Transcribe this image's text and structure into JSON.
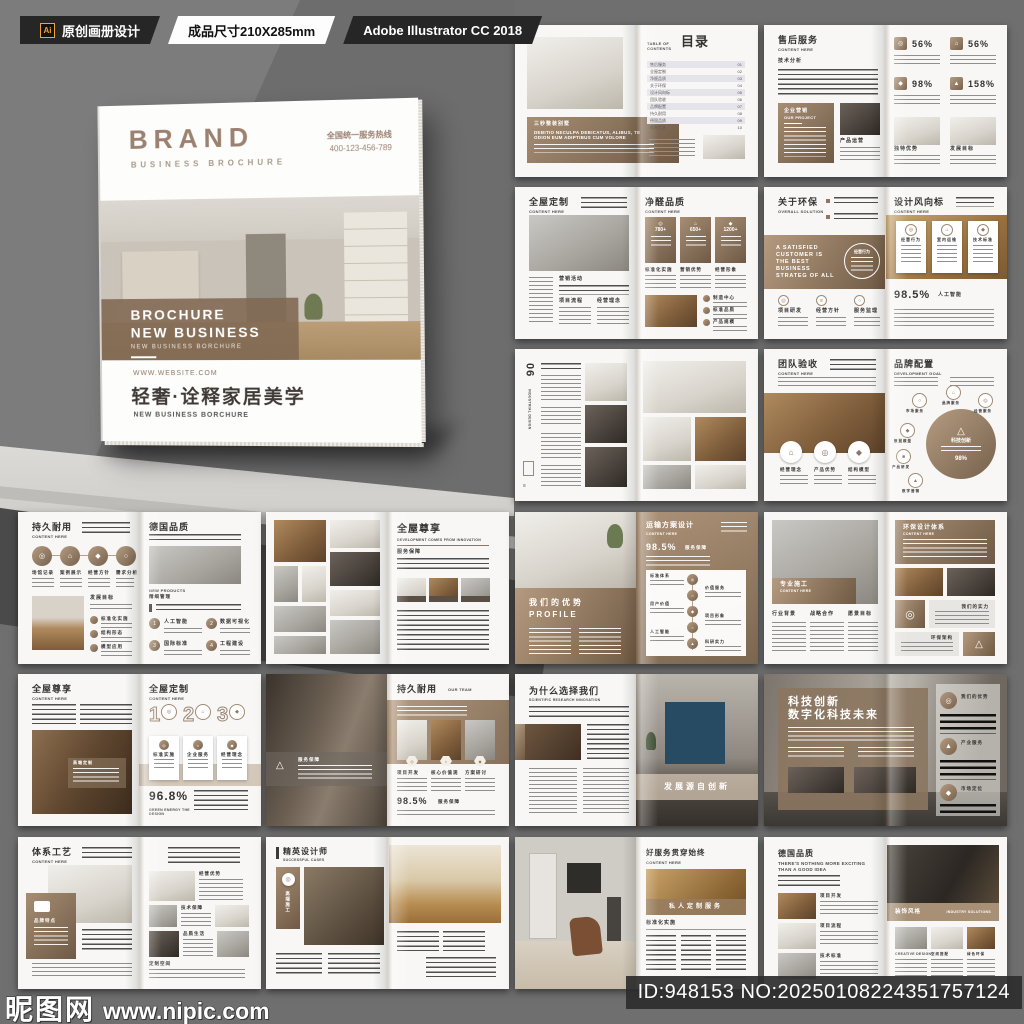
{
  "header": {
    "ai_badge": "Ai",
    "tag_design": "原创画册设计",
    "tag_size": "成品尺寸210X285mm",
    "tag_software": "Adobe Illustrator CC 2018"
  },
  "cover": {
    "brand": "BRAND",
    "brand_sub": "BUSINESS BROCHURE",
    "hotline_label": "全国统一服务热线",
    "hotline_number": "400-123-456-789",
    "band_line1": "BROCHURE",
    "band_line2": "NEW BUSINESS",
    "band_sub": "NEW BUSINESS BORCHURE",
    "website": "WWW.WEBSITE.COM",
    "tagline": "轻奢·诠释家居美学",
    "tagline_sub": "NEW BUSINESS BORCHURE"
  },
  "footer": {
    "site_name": "昵图网",
    "site_url": "www.nipic.com",
    "image_id": "ID:948153 NO:20250108224351757124"
  },
  "icons": {
    "target": "◎",
    "home": "⌂",
    "triangle": "△",
    "mail": "✉",
    "check": "✓",
    "diamond": "◆",
    "dot": "●",
    "square": "■",
    "circle": "○",
    "chart": "▲",
    "menu": "≡"
  },
  "spreads": {
    "s1": {
      "box_title": "三秒整装别墅",
      "box_text": "DEBITIO NECULPA DEBICATUS, ALIBUS, TE ODION EUM ADIPTIBUS CUM VOLORE",
      "toc_label": "TABLE OF CONTENTS",
      "toc_title": "目录",
      "toc": [
        "售后服务",
        "全屋定制",
        "净醛品质",
        "关于环保",
        "设计风向标",
        "团队验收",
        "品牌配置",
        "持久耐用",
        "德国品质",
        "体系工艺"
      ],
      "toc_nums": [
        "01",
        "02",
        "03",
        "04",
        "05",
        "06",
        "07",
        "08",
        "09",
        "10"
      ]
    },
    "s2": {
      "title": "售后服务",
      "title_en": "CONTENT HERE",
      "sub": "技术分析",
      "box_title": "企业营销",
      "box_en": "OUR PROJECT",
      "photo_cap": "产品运营",
      "stats": [
        "56%",
        "56%",
        "98%",
        "158%"
      ],
      "caps": [
        "独特优势",
        "发展目标"
      ]
    },
    "s3": {
      "title": "全屋定制",
      "title_en": "CONTENT HERE",
      "sec1": "营销活动",
      "sec2": "项目流程",
      "sec3": "经营理念",
      "right_title": "净醛品质",
      "right_en": "CONTENT HERE",
      "cards": [
        "780+",
        "650+",
        "1200+"
      ],
      "card_caps": [
        "标准化实施",
        "营销优势",
        "经营形象"
      ],
      "bullets": [
        "制造中心",
        "标准品质",
        "产品规模"
      ]
    },
    "s4": {
      "title": "关于环保",
      "title_en": "OVERALL SOLUTION",
      "quote": "A SATISFIED CUSTOMER IS THE BEST BUSINESS STRATEG OF ALL",
      "circle_cap": "经营行为",
      "cols": [
        "项目研发",
        "经营方针",
        "服务监理"
      ],
      "right_title": "设计风向标",
      "right_en": "CONTENT HERE",
      "cards": [
        "经营行为",
        "室内运维",
        "技术标准"
      ],
      "stat": "98.5%",
      "stat_cap": "人工智能"
    },
    "s5": {
      "num": "06",
      "side": "INDUSTRIAL DESIGN"
    },
    "s6": {
      "title": "团队验收",
      "title_en": "CONTENT HERE",
      "circles": [
        "经营理念",
        "产品优势",
        "结构模型"
      ],
      "right_title": "品牌配置",
      "right_en": "DEVELOPMENT GOAL",
      "center": "科技创新",
      "center_stat": "98%",
      "sats": [
        "市场服务",
        "品牌服务",
        "经营服务",
        "数据模型",
        "产品研发",
        "数字营销"
      ]
    },
    "s7": {
      "title": "持久耐用",
      "title_en": "CONTENT HERE",
      "circles": [
        "场馆记录",
        "案例展示",
        "经营方针",
        "需求分析"
      ],
      "sec": "发展目标",
      "list": [
        "标准化实施",
        "结构形态",
        "模型应用"
      ],
      "right_title": "德国品质",
      "right_en": "NEW PRODUCTS",
      "right_sub": "精细管理",
      "nums": [
        "1",
        "2",
        "3",
        "4"
      ],
      "num_caps": [
        "人工智能",
        "数据可视化",
        "国际标准",
        "工程建设"
      ]
    },
    "s8": {
      "right_title": "全屋尊享",
      "right_en": "DEVELOPMENT COMES FROM INNOVATION",
      "sub": "服务保障"
    },
    "s9": {
      "left_title": "我们的优势",
      "left_en": "PROFILE",
      "right_title": "运输方案设计",
      "right_en": "CONTENT HERE",
      "stat": "98.5%",
      "stat_cap": "服务保障",
      "tl_left": [
        "标准体系",
        "用户价值",
        "人工智能"
      ],
      "tl_right": [
        "价值服务",
        "项目形象",
        "科研实力"
      ]
    },
    "s10": {
      "band_title": "专业施工",
      "band_en": "CONTENT HERE",
      "cols": [
        "行业背景",
        "战略合作",
        "愿景目标"
      ],
      "box_title": "环保设计体系",
      "box_en": "CONTENT HERE",
      "gray1": "我们的实力",
      "gray2": "环保架构"
    },
    "s11": {
      "title": "全屋尊享",
      "title_en": "CONTENT HERE",
      "overlay": "高端定制",
      "right_title": "全屋定制",
      "right_en": "CONTENT HERE",
      "nums": [
        "1",
        "2",
        "3"
      ],
      "num_caps": [
        "标准实施",
        "企业服务",
        "经营理念"
      ],
      "stat": "96.8%",
      "stat_en": "GREEN ENERGY THE DESIGN"
    },
    "s12": {
      "overlay": "服务保障",
      "right_title": "持久耐用",
      "right_en": "OUR TEAM",
      "hex_caps": [
        "项目开发",
        "核心价值观",
        "方案研讨"
      ],
      "stat": "98.5%",
      "stat_cap": "服务保障"
    },
    "s13": {
      "title": "为什么选择我们",
      "title_en": "SCIENTIFIC RESEARCH INNOVATION",
      "overlay": "发展源自创新"
    },
    "s14": {
      "panel1": "科技创新",
      "panel2": "数字化科技未来",
      "rows": [
        "我们的优势",
        "产业服务",
        "市场定位"
      ]
    },
    "s15": {
      "title": "体系工艺",
      "title_en": "CONTENT HERE",
      "box_cap": "品牌特点",
      "caps": [
        "经营优势",
        "技术保障",
        "品质生活",
        "定制空间"
      ]
    },
    "s16": {
      "title": "精英设计师",
      "title_en": "SUCCESSFUL CASES",
      "tag": "高端施工"
    },
    "s17": {
      "right_title": "好服务贯穿始终",
      "right_en": "CONTENT HERE",
      "band": "私人定制服务",
      "sub": "标准化实施"
    },
    "s18": {
      "title": "德国品质",
      "title_en": "THERE'S NOTHING MORE EXCITING THAN A GOOD IDEA",
      "rows": [
        "项目开发",
        "项目流程",
        "技术标准"
      ],
      "band": "装饰风格",
      "band_en": "INDUSTRY SOLUTIONS",
      "caps": [
        "CREATIVE DESIGN",
        "空间搭配",
        "绿色环保"
      ]
    }
  }
}
